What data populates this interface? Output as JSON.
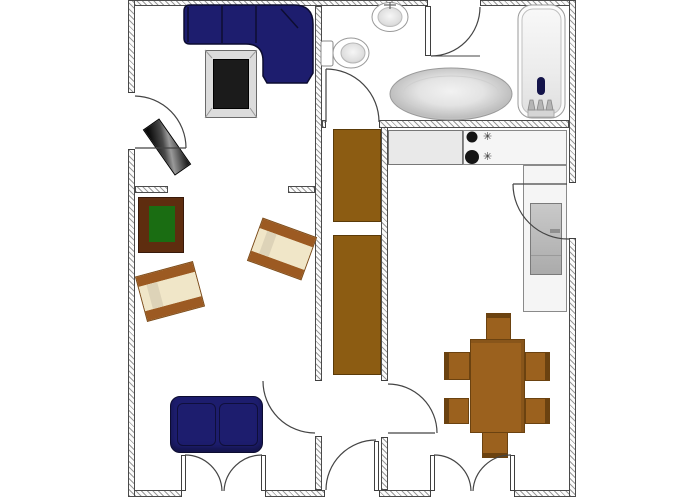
{
  "document": {
    "type": "apartment-floor-plan",
    "background": "#ffffff",
    "has_text_labels": false
  },
  "symbols": {
    "burner_control": "✳"
  },
  "palette": {
    "wall_fill": "#fbfbfb",
    "wall_hatch": "#9a9a9a",
    "wall_outline": "#4a4a4a",
    "line": "#3f3f3f",
    "sofa_navy": "#1d1d6e",
    "sofa_navy_dark": "#0c0c30",
    "closet_brown": "#8c5c12",
    "closet_brown_dark": "#5a3a08",
    "dining_brown": "#9b611e",
    "dining_brown_dark": "#6b4210",
    "table_maroon": "#5e2d0f",
    "table_green": "#1a6d12",
    "armchair_cream": "#f0e6c8",
    "armchair_shade": "#ddd3b8",
    "armchair_trim": "#9c5a22",
    "counter_gray": "#e9e9e9",
    "counter_light": "#f5f5f5",
    "fixture_white": "#fcfcfc"
  },
  "rooms": [
    {
      "id": "living-room",
      "furniture": [
        "corner-sofa",
        "tv",
        "media-bench",
        "side-table-green-top",
        "armchair",
        "armchair",
        "two-seat-sofa"
      ],
      "doors": [
        "balcony-door-left-wall",
        "door-to-hallway",
        "double-french-window"
      ]
    },
    {
      "id": "bathroom",
      "fixtures": [
        "toilet",
        "small-round-washbasin",
        "large-oval-washbasin",
        "bathtub"
      ],
      "doors": [
        "door-to-hallway",
        "partition-door"
      ]
    },
    {
      "id": "hallway",
      "furniture": [
        "wardrobe",
        "wardrobe"
      ],
      "doors": [
        "entrance-door"
      ]
    },
    {
      "id": "kitchen",
      "fixtures": [
        "countertop-l-shaped",
        "cooktop-two-burners",
        "refrigerator"
      ],
      "furniture": [
        "dining-table",
        "dining-chair",
        "dining-chair",
        "dining-chair",
        "dining-chair",
        "dining-chair",
        "dining-chair"
      ],
      "doors": [
        "door-to-hallway",
        "balcony-door-right-wall",
        "double-french-window"
      ]
    }
  ]
}
